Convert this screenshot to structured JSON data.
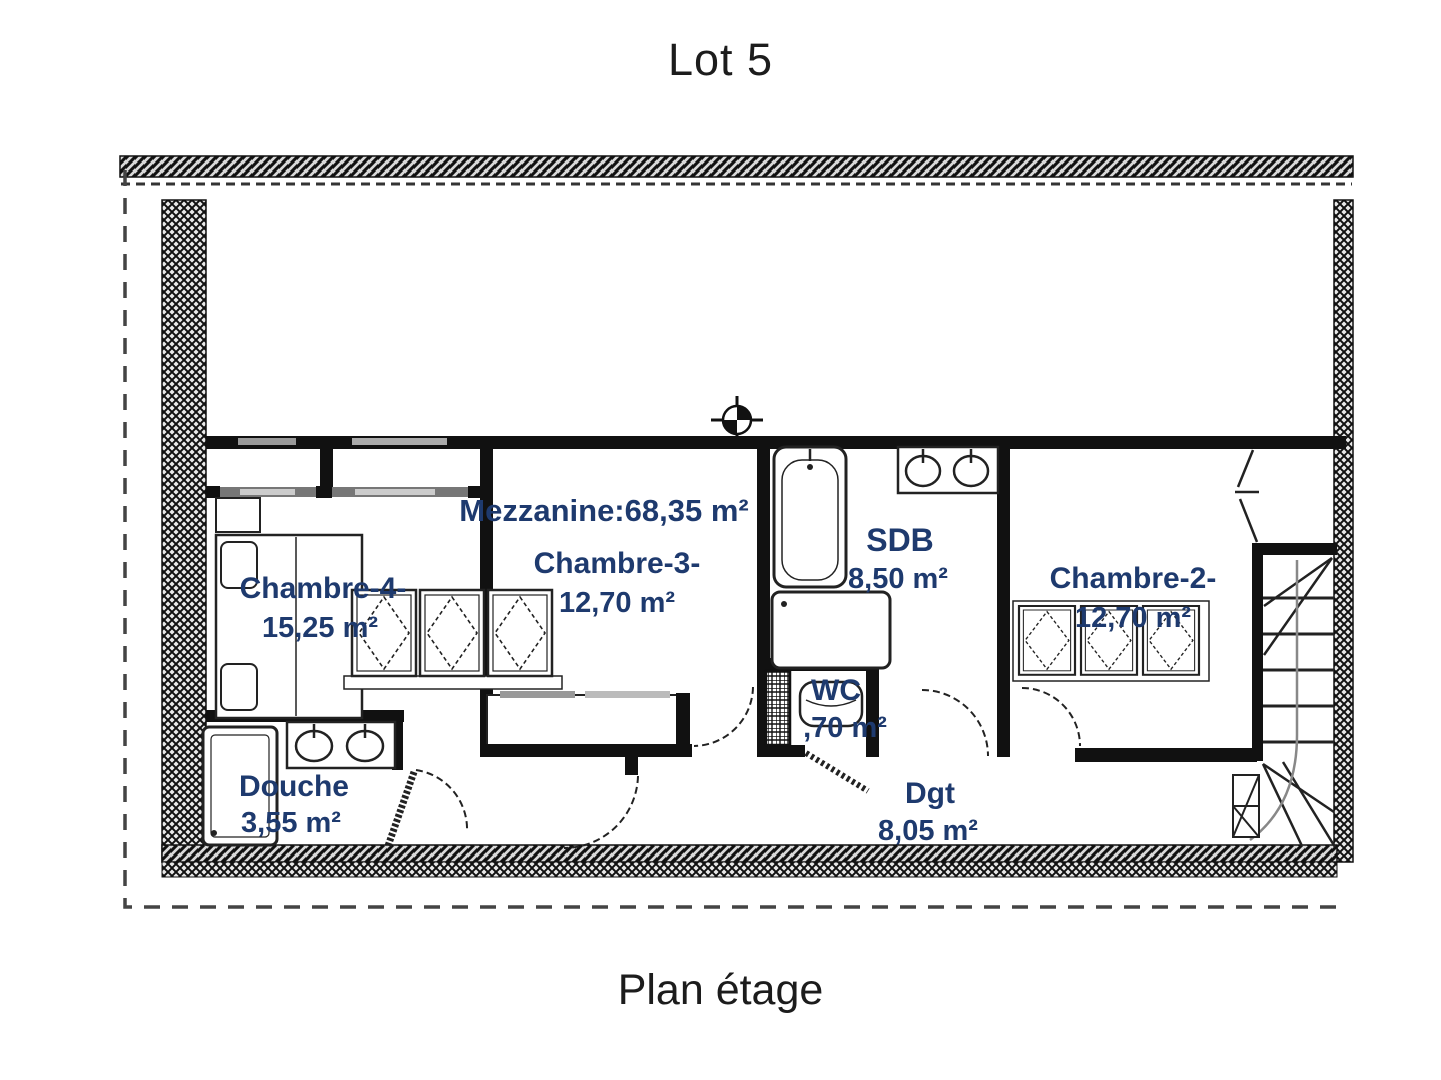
{
  "page": {
    "title": "Lot 5",
    "caption": "Plan étage"
  },
  "colors": {
    "room_label": "#1e3a6e",
    "wall": "#111111",
    "line": "#222222"
  },
  "rooms": {
    "mezzanine": {
      "label": "Mezzanine:68,35 m²"
    },
    "chambre4": {
      "name": "Chambre-4-",
      "area": "15,25 m²"
    },
    "chambre3": {
      "name": "Chambre-3-",
      "area": "12,70 m²"
    },
    "sdb": {
      "name": "SDB",
      "area": "8,50 m²"
    },
    "chambre2": {
      "name": "Chambre-2-",
      "area": "12,70 m²"
    },
    "wc": {
      "name": "WC",
      "area": ",70 m²"
    },
    "douche": {
      "name": "Douche",
      "area": "3,55 m²"
    },
    "dgt": {
      "name": "Dgt",
      "area": "8,05 m²"
    }
  }
}
